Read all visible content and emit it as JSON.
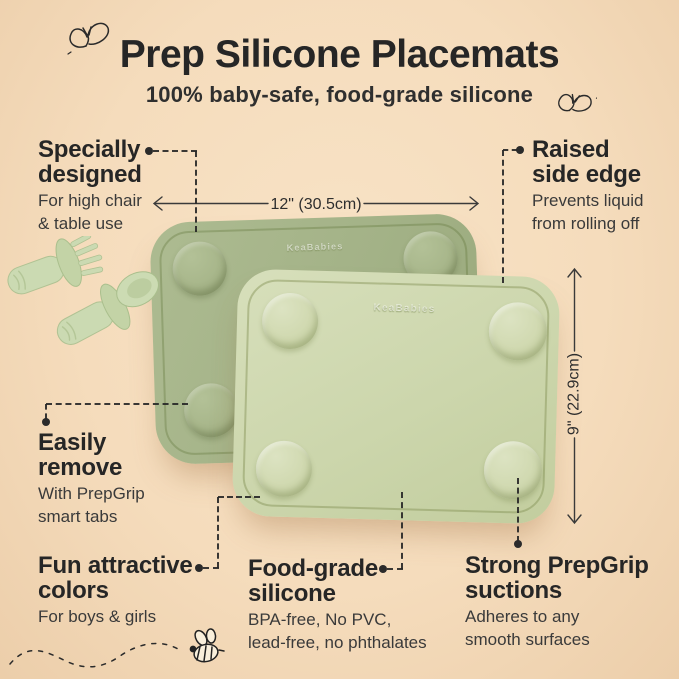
{
  "header": {
    "title": "Prep Silicone Placemats",
    "subtitle": "100% baby-safe, food-grade silicone"
  },
  "callouts": {
    "specially": {
      "heading": [
        "Specially",
        "designed"
      ],
      "desc": [
        "For high chair",
        "& table use"
      ]
    },
    "raised": {
      "heading": [
        "Raised",
        "side edge"
      ],
      "desc": [
        "Prevents liquid",
        "from rolling off"
      ]
    },
    "easily": {
      "heading": [
        "Easily",
        "remove"
      ],
      "desc": [
        "With PrepGrip",
        "smart tabs"
      ]
    },
    "colors": {
      "heading": [
        "Fun attractive",
        "colors"
      ],
      "desc": [
        "For boys & girls"
      ]
    },
    "foodgrade": {
      "heading": [
        "Food-grade",
        "silicone"
      ],
      "desc": [
        "BPA-free, No PVC,",
        "lead-free, no phthalates"
      ]
    },
    "suctions": {
      "heading": [
        "Strong PrepGrip",
        "suctions"
      ],
      "desc": [
        "Adheres to any",
        "smooth surfaces"
      ]
    }
  },
  "dimensions": {
    "width_label": "12\" (30.5cm)",
    "height_label": "9\" (22.9cm)"
  },
  "product": {
    "brand": "KeaBabies",
    "mat_back_color": "#a3b287",
    "mat_front_color": "#ccd6ac",
    "utensil_color": "#cbdab2"
  },
  "decorations": {
    "butterfly_icon_count": 2,
    "bee_icon": "bee-doodle"
  },
  "colors": {
    "background": "#f5dcbc",
    "text_dark": "#262626",
    "line": "#2b2b2b"
  }
}
